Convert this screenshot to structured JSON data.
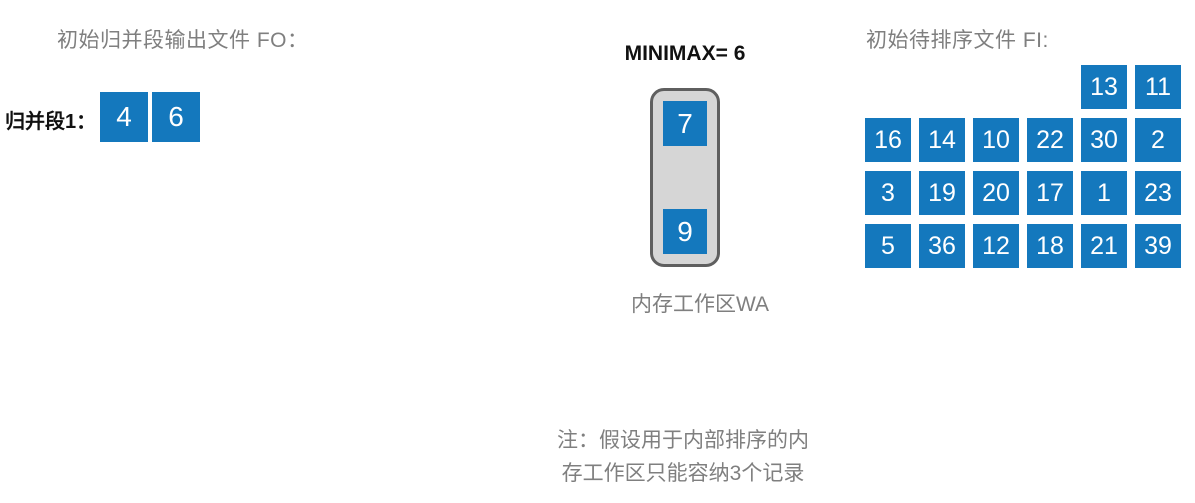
{
  "colors": {
    "box_blue": "#1478bd",
    "wa_fill": "#d6d6d6",
    "wa_border": "#5f5f5f",
    "text_gray": "#7f7f7f",
    "text_black": "#111111"
  },
  "fo_section": {
    "title": "初始归并段输出文件 FO：",
    "segment_label": "归并段1：",
    "values": [
      "4",
      "6"
    ]
  },
  "wa_section": {
    "minimax_label": "MINIMAX= 6",
    "values": [
      "7",
      "9"
    ],
    "caption": "内存工作区WA"
  },
  "fi_section": {
    "title": "初始待排序文件 FI:",
    "grid": [
      [
        "",
        "",
        "",
        "",
        "13",
        "11"
      ],
      [
        "16",
        "14",
        "10",
        "22",
        "30",
        "2"
      ],
      [
        "3",
        "19",
        "20",
        "17",
        "1",
        "23"
      ],
      [
        "5",
        "36",
        "12",
        "18",
        "21",
        "39"
      ]
    ]
  },
  "note": {
    "line1": "注：假设用于内部排序的内",
    "line2": "存工作区只能容纳3个记录"
  }
}
